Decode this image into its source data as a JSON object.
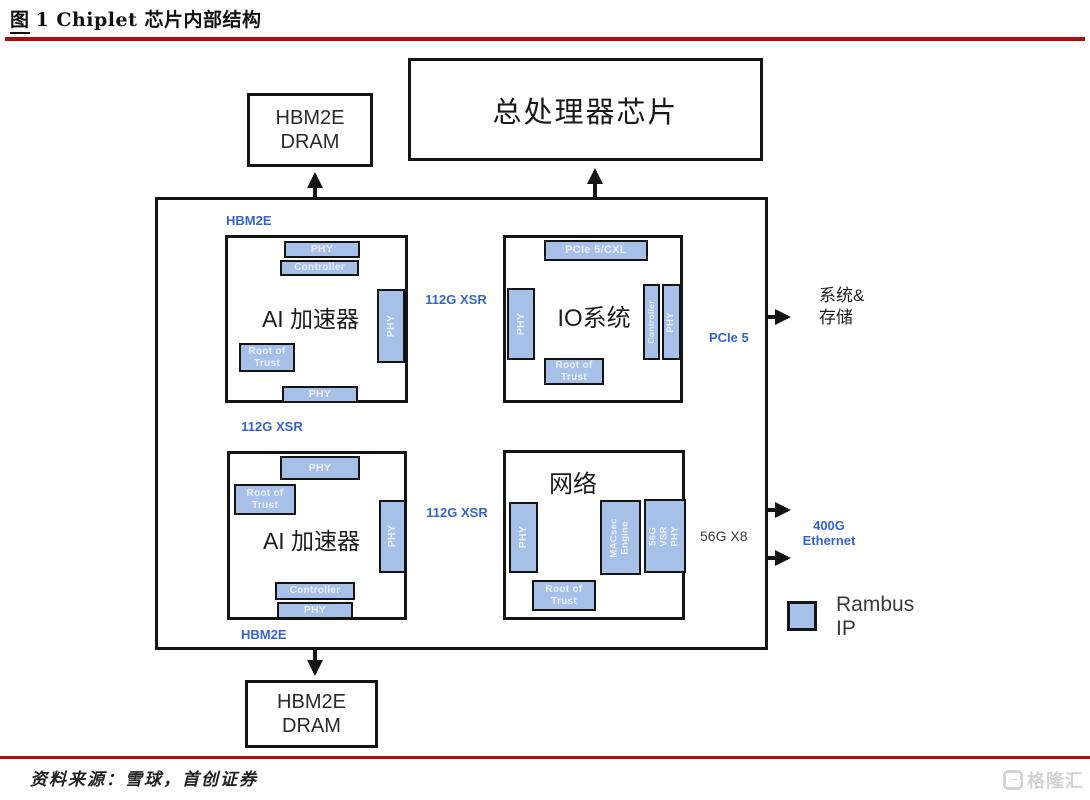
{
  "header": {
    "figure_label": "图",
    "title": "1 Chiplet 芯片内部结构"
  },
  "chips_outer": {
    "hbm_dram_top": "HBM2E\nDRAM",
    "cpu": "总处理器芯片",
    "hbm_dram_bottom": "HBM2E\nDRAM"
  },
  "blocks": {
    "ai1": {
      "title": "AI 加速器",
      "phy_top": "PHY",
      "controller": "Controller",
      "root_of_trust": "Root of\nTrust",
      "phy_right": "PHY",
      "phy_bottom": "PHY"
    },
    "io": {
      "title": "IO系统",
      "pcie_cxl": "PCIe 5/CXL",
      "phy_left": "PHY",
      "controller": "Controller",
      "phy_right": "PHY",
      "root_of_trust": "Root of\nTrust"
    },
    "ai2": {
      "title": "AI 加速器",
      "phy_top": "PHY",
      "root_of_trust": "Root of\nTrust",
      "phy_right": "PHY",
      "controller": "Controller",
      "phy_bottom": "PHY"
    },
    "net": {
      "title": "网络",
      "phy_left": "PHY",
      "macsec": "MACsec\nEngine",
      "vsr_phy": "56G VSR\nPHY",
      "root_of_trust": "Root of\nTrust"
    }
  },
  "labels": {
    "hbm2e_top": "HBM2E",
    "hbm2e_bottom": "HBM2E",
    "xsr_top": "112G XSR",
    "xsr_left": "112G XSR",
    "xsr_bottom": "112G XSR",
    "pcie5": "PCIe 5",
    "sys_storage": "系统&\n存储",
    "g56x8": "56G X8",
    "eth400g": "400G\nEthernet"
  },
  "legend": {
    "label": "Rambus\nIP"
  },
  "footer": {
    "source": "资料来源：雪球，首创证券",
    "watermark": "格隆汇"
  },
  "colors": {
    "block_fill": "#a6c0e7",
    "accent_blue": "#3565c6",
    "rule_red": "#b30a0a"
  }
}
